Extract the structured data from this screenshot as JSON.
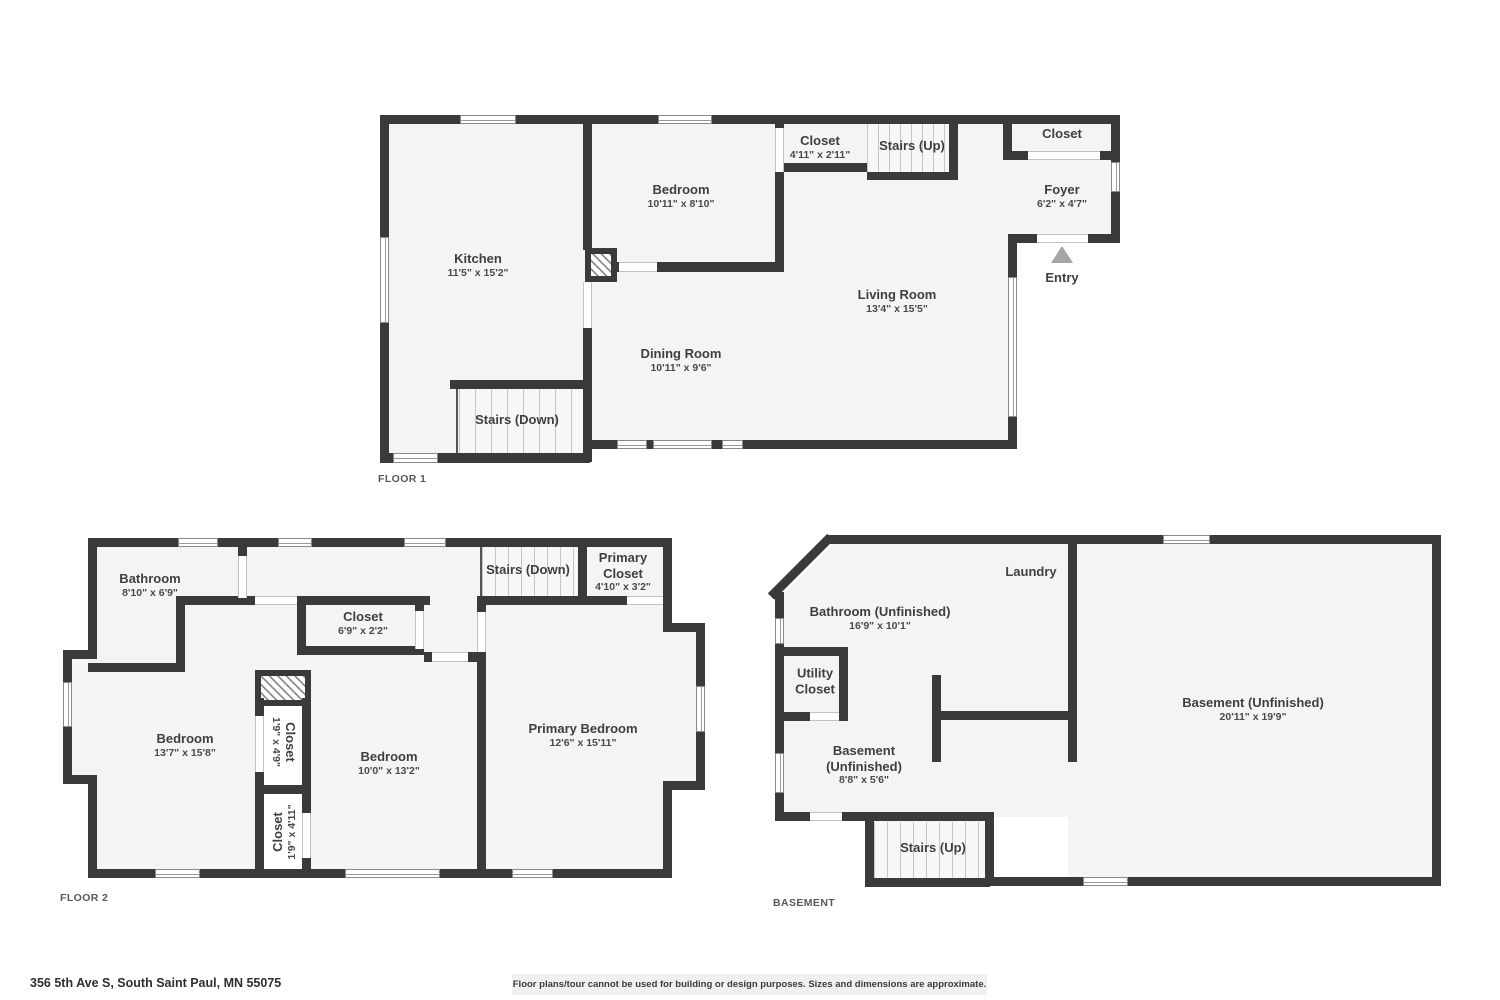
{
  "floor1": {
    "plan_label": "FLOOR 1",
    "rooms": {
      "kitchen": {
        "name": "Kitchen",
        "dims": "11'5\" x 15'2\""
      },
      "bedroom": {
        "name": "Bedroom",
        "dims": "10'11\" x 8'10\""
      },
      "closet": {
        "name": "Closet",
        "dims": "4'11\" x 2'11\""
      },
      "stairs_up": {
        "name": "Stairs (Up)"
      },
      "entry_closet": {
        "name": "Closet"
      },
      "foyer": {
        "name": "Foyer",
        "dims": "6'2\" x 4'7\""
      },
      "entry": {
        "name": "Entry"
      },
      "living": {
        "name": "Living Room",
        "dims": "13'4\" x 15'5\""
      },
      "dining": {
        "name": "Dining Room",
        "dims": "10'11\" x 9'6\""
      },
      "stairs_down": {
        "name": "Stairs (Down)"
      }
    }
  },
  "floor2": {
    "plan_label": "FLOOR 2",
    "rooms": {
      "bathroom": {
        "name": "Bathroom",
        "dims": "8'10\" x 6'9\""
      },
      "hall_closet": {
        "name": "Closet",
        "dims": "6'9\" x 2'2\""
      },
      "stairs_down": {
        "name": "Stairs (Down)"
      },
      "primary_closet": {
        "name": "Primary Closet",
        "dims": "4'10\" x 3'2\""
      },
      "bedroom_left": {
        "name": "Bedroom",
        "dims": "13'7\" x 15'8\""
      },
      "closet_upper": {
        "name": "Closet",
        "dims": "1'9\" x 4'9\""
      },
      "bedroom_middle": {
        "name": "Bedroom",
        "dims": "10'0\" x 13'2\""
      },
      "closet_lower": {
        "name": "Closet",
        "dims": "1'9\" x 4'11\""
      },
      "primary_bedroom": {
        "name": "Primary Bedroom",
        "dims": "12'6\" x 15'11\""
      }
    }
  },
  "basement": {
    "plan_label": "BASEMENT",
    "rooms": {
      "laundry": {
        "name": "Laundry"
      },
      "bathroom": {
        "name": "Bathroom (Unfinished)",
        "dims": "16'9\" x 10'1\""
      },
      "utility_closet": {
        "name": "Utility Closet"
      },
      "basement_small": {
        "name": "Basement (Unfinished)",
        "dims": "8'8\" x 5'6\""
      },
      "basement_large": {
        "name": "Basement (Unfinished)",
        "dims": "20'11\" x 19'9\""
      },
      "stairs_up": {
        "name": "Stairs (Up)"
      }
    }
  },
  "footer": {
    "address": "356 5th Ave S, South Saint Paul, MN 55075",
    "disclaimer": "Floor plans/tour cannot be used for building or design purposes. Sizes and dimensions are approximate."
  }
}
